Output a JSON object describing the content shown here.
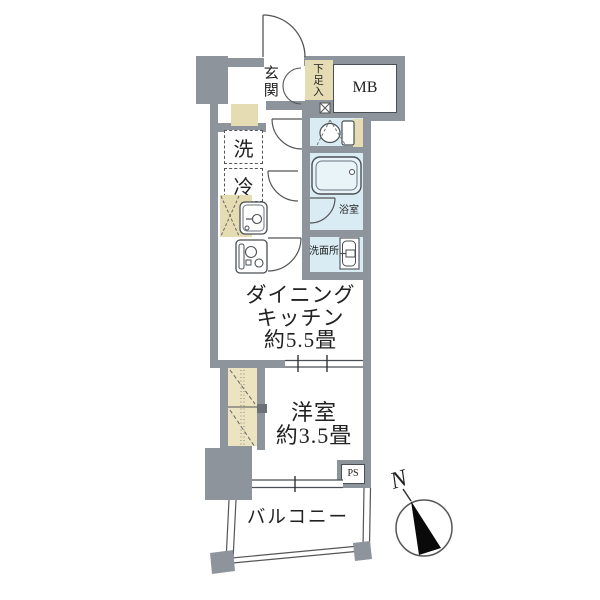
{
  "floorplan": {
    "labels": {
      "entrance": "玄関",
      "shoe_storage": "下足入",
      "meter_box": "MB",
      "washer": "洗",
      "fridge": "冷",
      "bathroom": "浴室",
      "washroom": "洗面所",
      "dining_kitchen": [
        "ダイニング",
        "キッチン",
        "約5.5畳"
      ],
      "western_room": [
        "洋室",
        "約3.5畳"
      ],
      "balcony": "バルコニー",
      "pipe_space": "PS",
      "north": "N"
    },
    "areas": {
      "dining_kitchen_size": "約5.5畳",
      "western_room_size": "約3.5畳"
    },
    "colors": {
      "wall": "#8e949c",
      "wet_area": "#d9ecf4",
      "storage": "#e6dcb3",
      "closet": "#ece3c1",
      "line": "#4a4f55",
      "north_arrow": "#0a0a0a"
    }
  }
}
